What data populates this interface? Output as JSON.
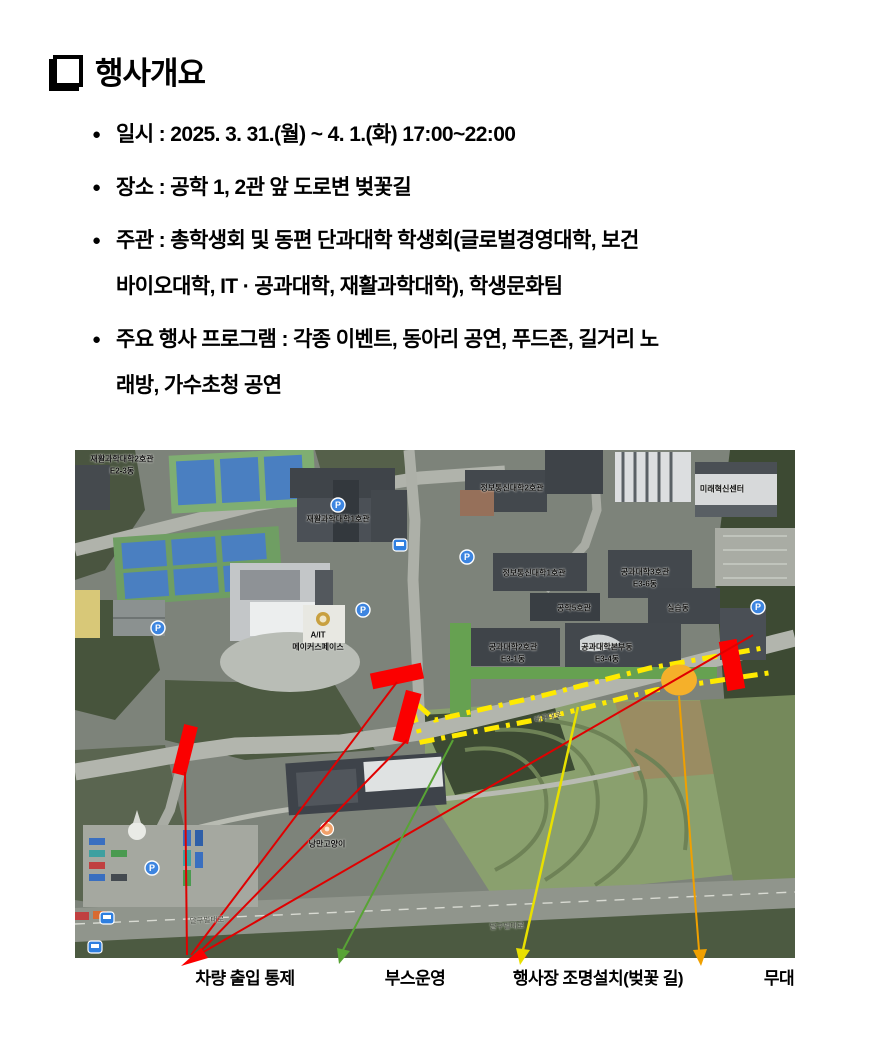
{
  "title": {
    "glyph": "□",
    "text": "행사개요"
  },
  "bullets": [
    {
      "marker": "●",
      "lines": [
        "일시 : 2025. 3. 31.(월) ~ 4. 1.(화) 17:00~22:00",
        ""
      ]
    },
    {
      "marker": "●",
      "lines": [
        "장소 : 공학 1, 2관 앞 도로변 벚꽃길",
        ""
      ]
    },
    {
      "marker": "●",
      "lines": [
        "주관 : 총학생회 및 동편 단과대학 학생회(글로벌경영대학, 보건",
        "바이오대학, IT · 공과대학, 재활과학대학), 학생문화팀"
      ]
    },
    {
      "marker": "●",
      "lines": [
        "주요 행사 프로그램 : 각종 이벤트, 동아리 공연, 푸드존, 길거리 노",
        "래방, 가수초청 공연"
      ]
    }
  ],
  "map": {
    "labels": [
      {
        "x": 47,
        "y": 9,
        "text": "재활과학대학2호관"
      },
      {
        "x": 47,
        "y": 21,
        "text": "E2-3동"
      },
      {
        "x": 263,
        "y": 69,
        "text": "재활과학대학1호관"
      },
      {
        "x": 647,
        "y": 39,
        "text": "미래혁신센터"
      },
      {
        "x": 437,
        "y": 38,
        "text": "정보통신대학2호관"
      },
      {
        "x": 459,
        "y": 123,
        "text": "정보통신대학1호관"
      },
      {
        "x": 570,
        "y": 122,
        "text": "공과대학3호관"
      },
      {
        "x": 570,
        "y": 134,
        "text": "E3-6동"
      },
      {
        "x": 499,
        "y": 158,
        "text": "공학5호관"
      },
      {
        "x": 603,
        "y": 158,
        "text": "실습동"
      },
      {
        "x": 438,
        "y": 197,
        "text": "공과대학2호관"
      },
      {
        "x": 438,
        "y": 209,
        "text": "E3-1동"
      },
      {
        "x": 532,
        "y": 197,
        "text": "공과대학본부동"
      },
      {
        "x": 532,
        "y": 209,
        "text": "E3-4동"
      },
      {
        "x": 243,
        "y": 185,
        "text": "A/IT"
      },
      {
        "x": 243,
        "y": 197,
        "text": "메이커스페이스"
      },
      {
        "x": 252,
        "y": 394,
        "text": "낭만고양이"
      },
      {
        "x": 473,
        "y": 267,
        "text": "대구대로",
        "cls": "road",
        "rot": -12
      },
      {
        "x": 132,
        "y": 470,
        "text": "달구벌대로",
        "cls": "road",
        "rot": -3
      },
      {
        "x": 432,
        "y": 476,
        "text": "달구벌대로",
        "cls": "road",
        "rot": -2
      }
    ],
    "overlay_colors": {
      "traffic_control": "#ff0000",
      "booth_zone": "#66a151",
      "lighting_line": "#ffea00",
      "stage": "#f5b02a"
    }
  },
  "legend": {
    "items": [
      {
        "label": "차량 출입 통제",
        "color": "#ff0000"
      },
      {
        "label": "부스운영",
        "color": "#58a335"
      },
      {
        "label": "행사장 조명설치(벚꽃 길)",
        "color": "#e8e000"
      },
      {
        "label": "무대",
        "color": "#f0a000"
      }
    ]
  }
}
